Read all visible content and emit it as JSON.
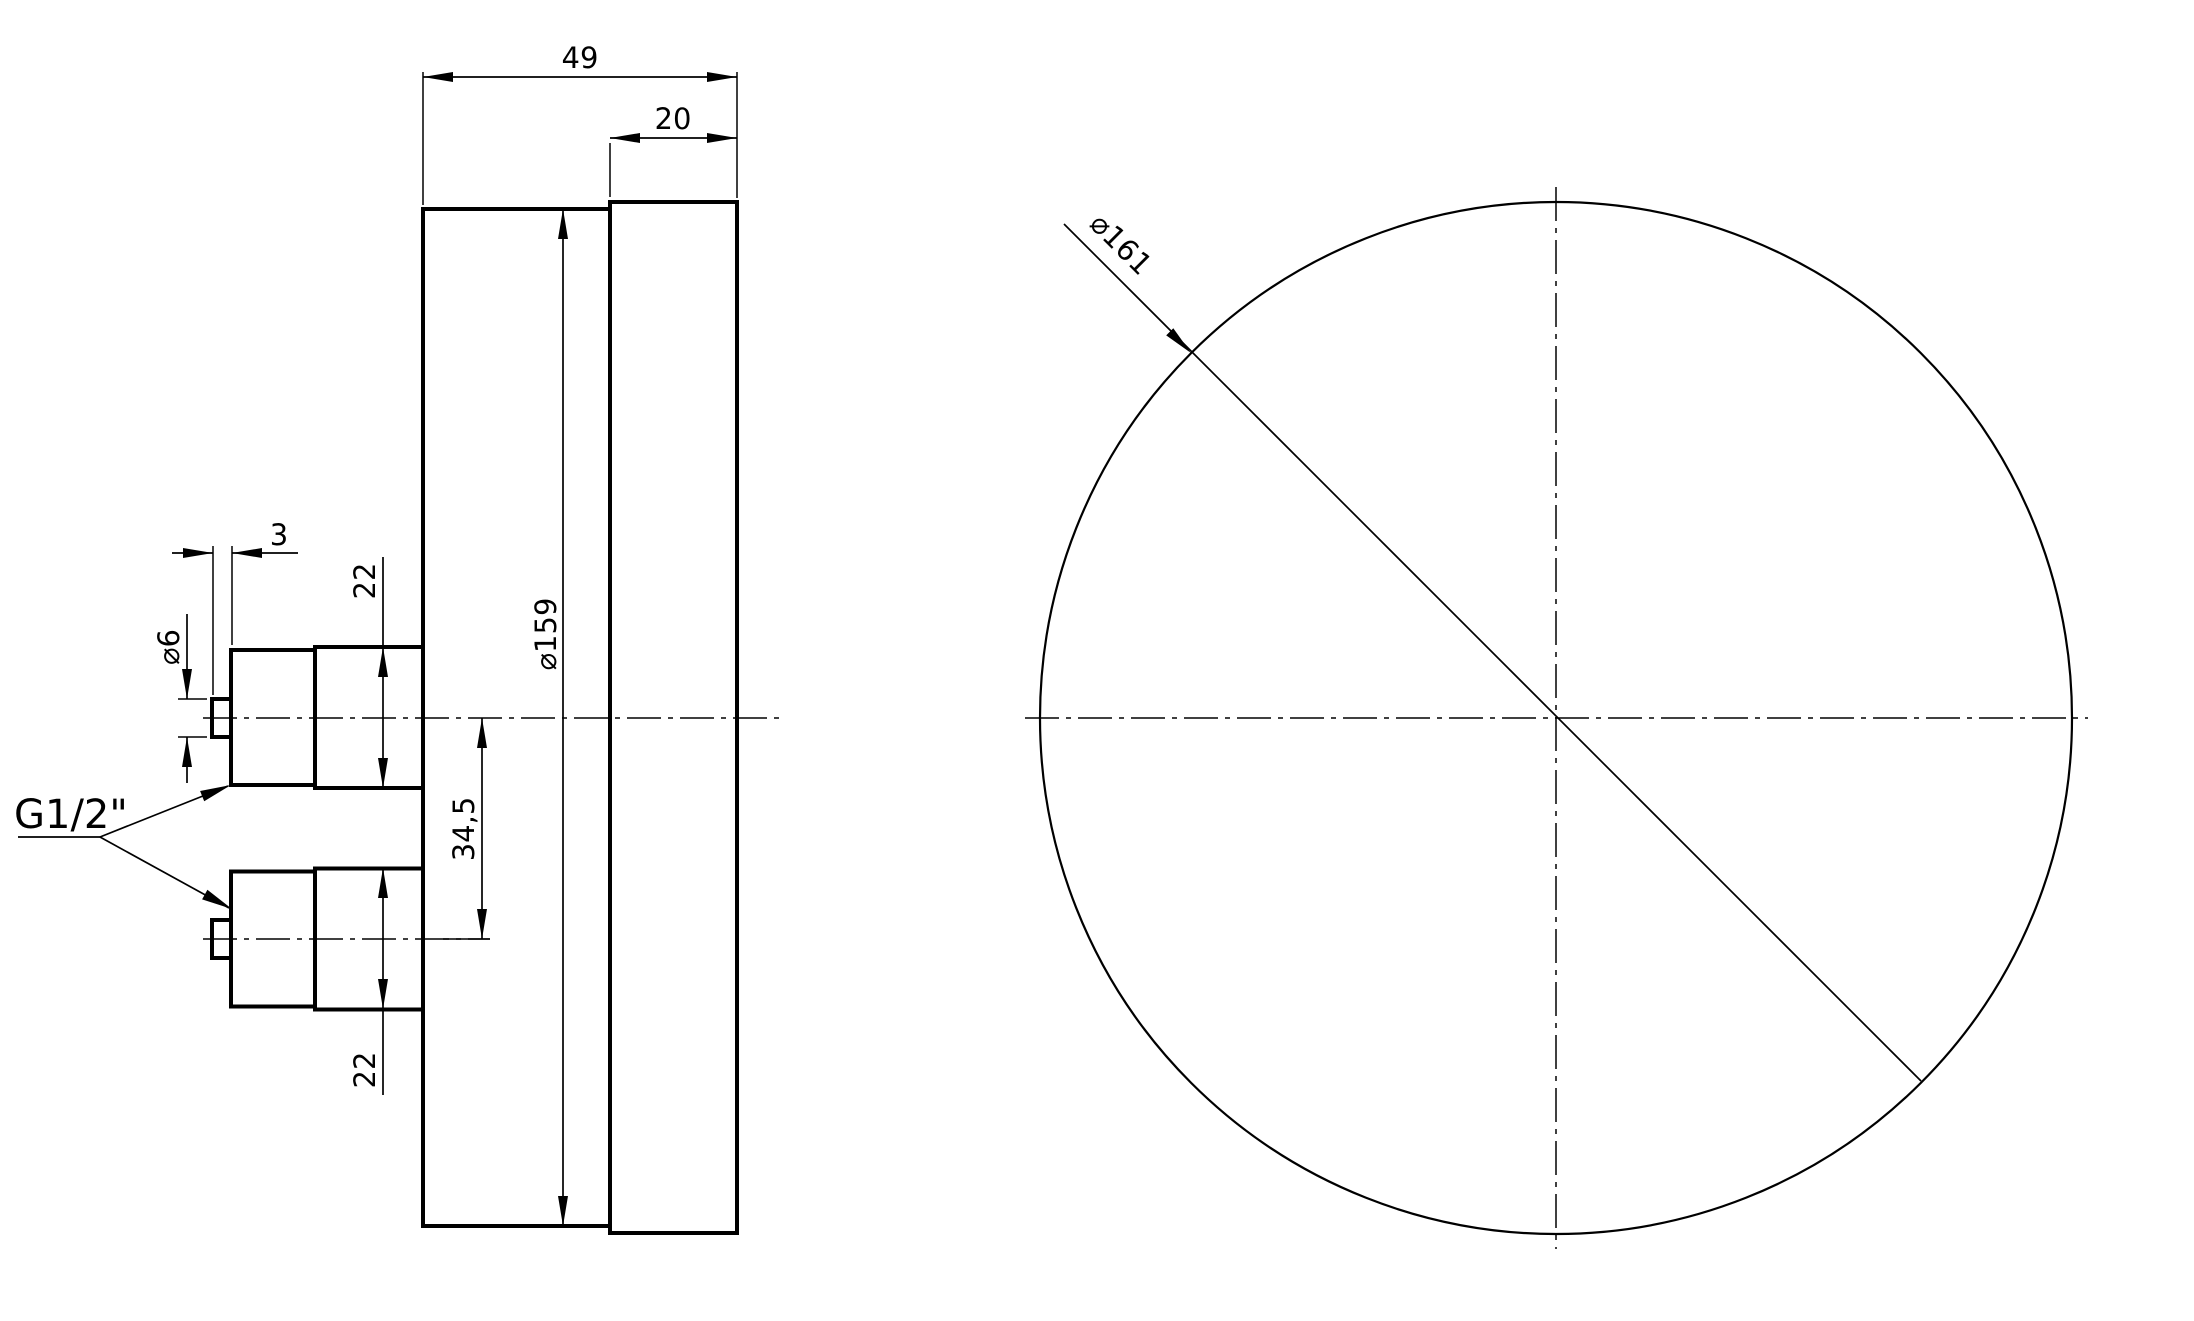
{
  "drawing": {
    "type": "technical-drawing",
    "subject": "rear-entry pressure gauge, side and front orthographic views",
    "background_color": "#ffffff",
    "line_color": "#000000",
    "side_view": {
      "labels": {
        "depth_total": "49",
        "bezel_depth": "20",
        "case_diameter": "⌀159",
        "center_offset": "34,5",
        "upper_fitting_od": "22",
        "lower_fitting_od": "22",
        "nipple_length": "3",
        "nipple_diameter": "⌀6",
        "thread": "G1/2\""
      }
    },
    "front_view": {
      "labels": {
        "outer_diameter": "⌀161"
      }
    }
  }
}
